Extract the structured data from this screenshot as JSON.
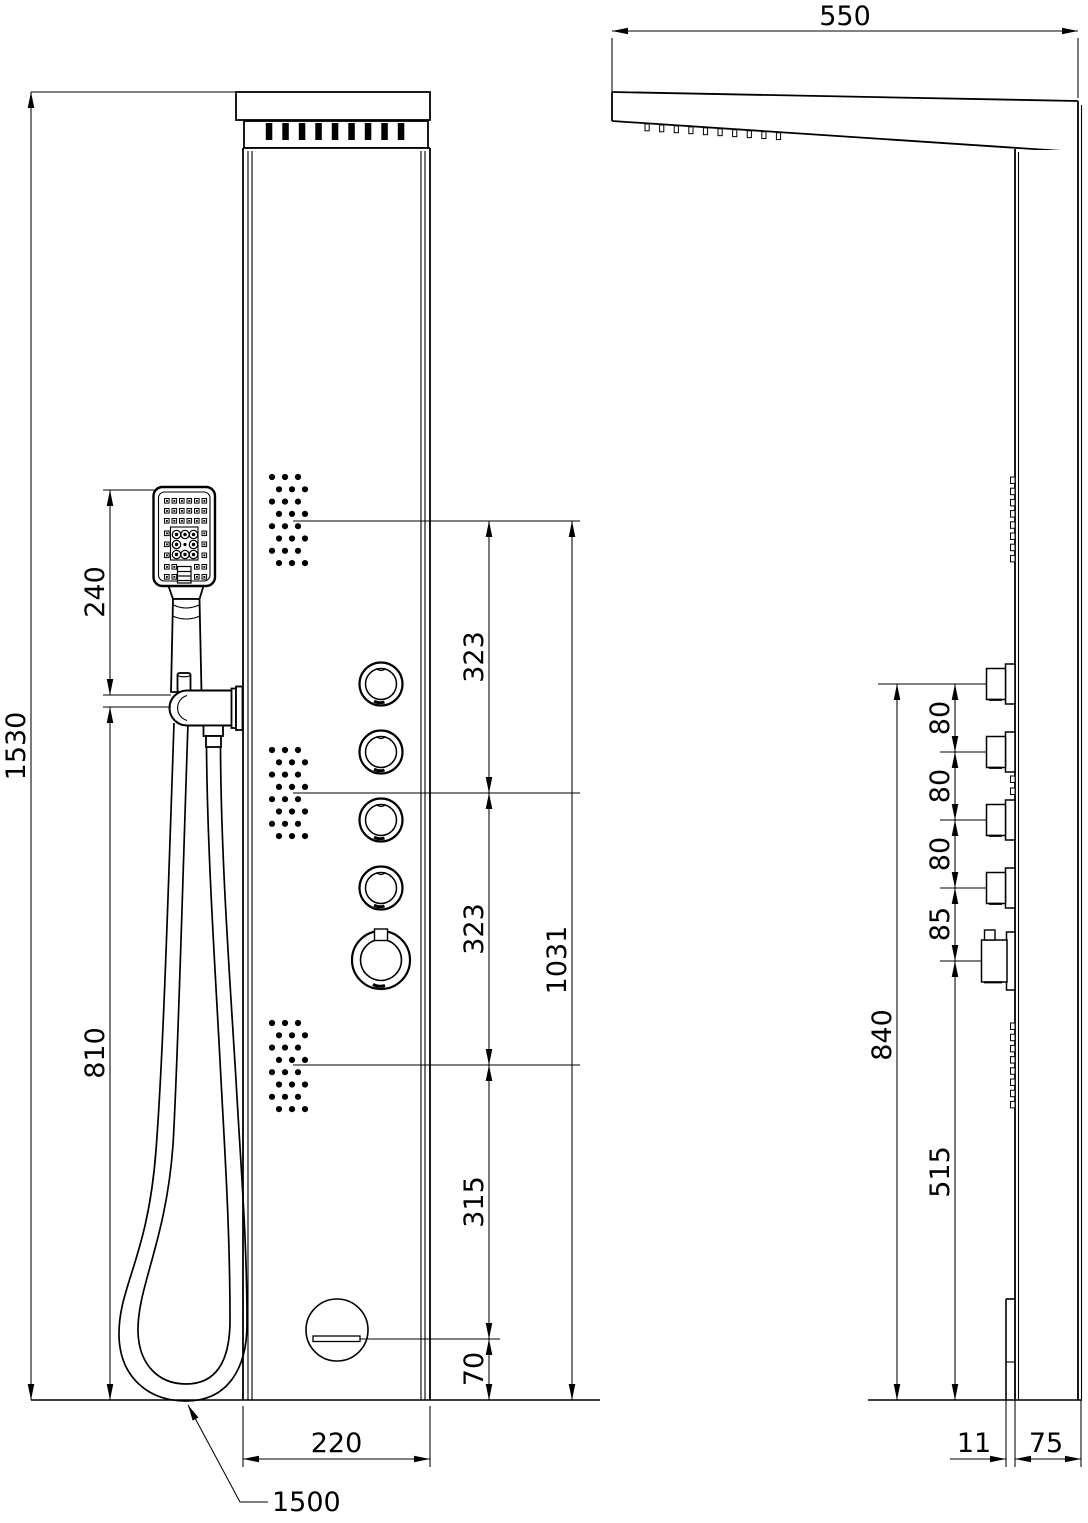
{
  "dimensions": {
    "front": {
      "total_height": "1530",
      "handshower_top_to_holder": "240",
      "holder_to_bottom": "810",
      "upper_jets_spacing": "323",
      "middle_jets_spacing": "323",
      "jets_top_to_bottom": "1031",
      "lower_jet_to_spout": "315",
      "spout_to_bottom": "70",
      "panel_width": "220",
      "hose_length": "1500"
    },
    "side": {
      "rain_head_projection": "550",
      "knob1_to_knob2": "80",
      "knob2_to_knob3": "80",
      "knob3_to_knob4": "80",
      "knob4_to_mixer": "85",
      "top_knob_to_bottom": "840",
      "mixer_to_bottom": "515",
      "spout_projection": "11",
      "panel_depth": "75"
    }
  }
}
